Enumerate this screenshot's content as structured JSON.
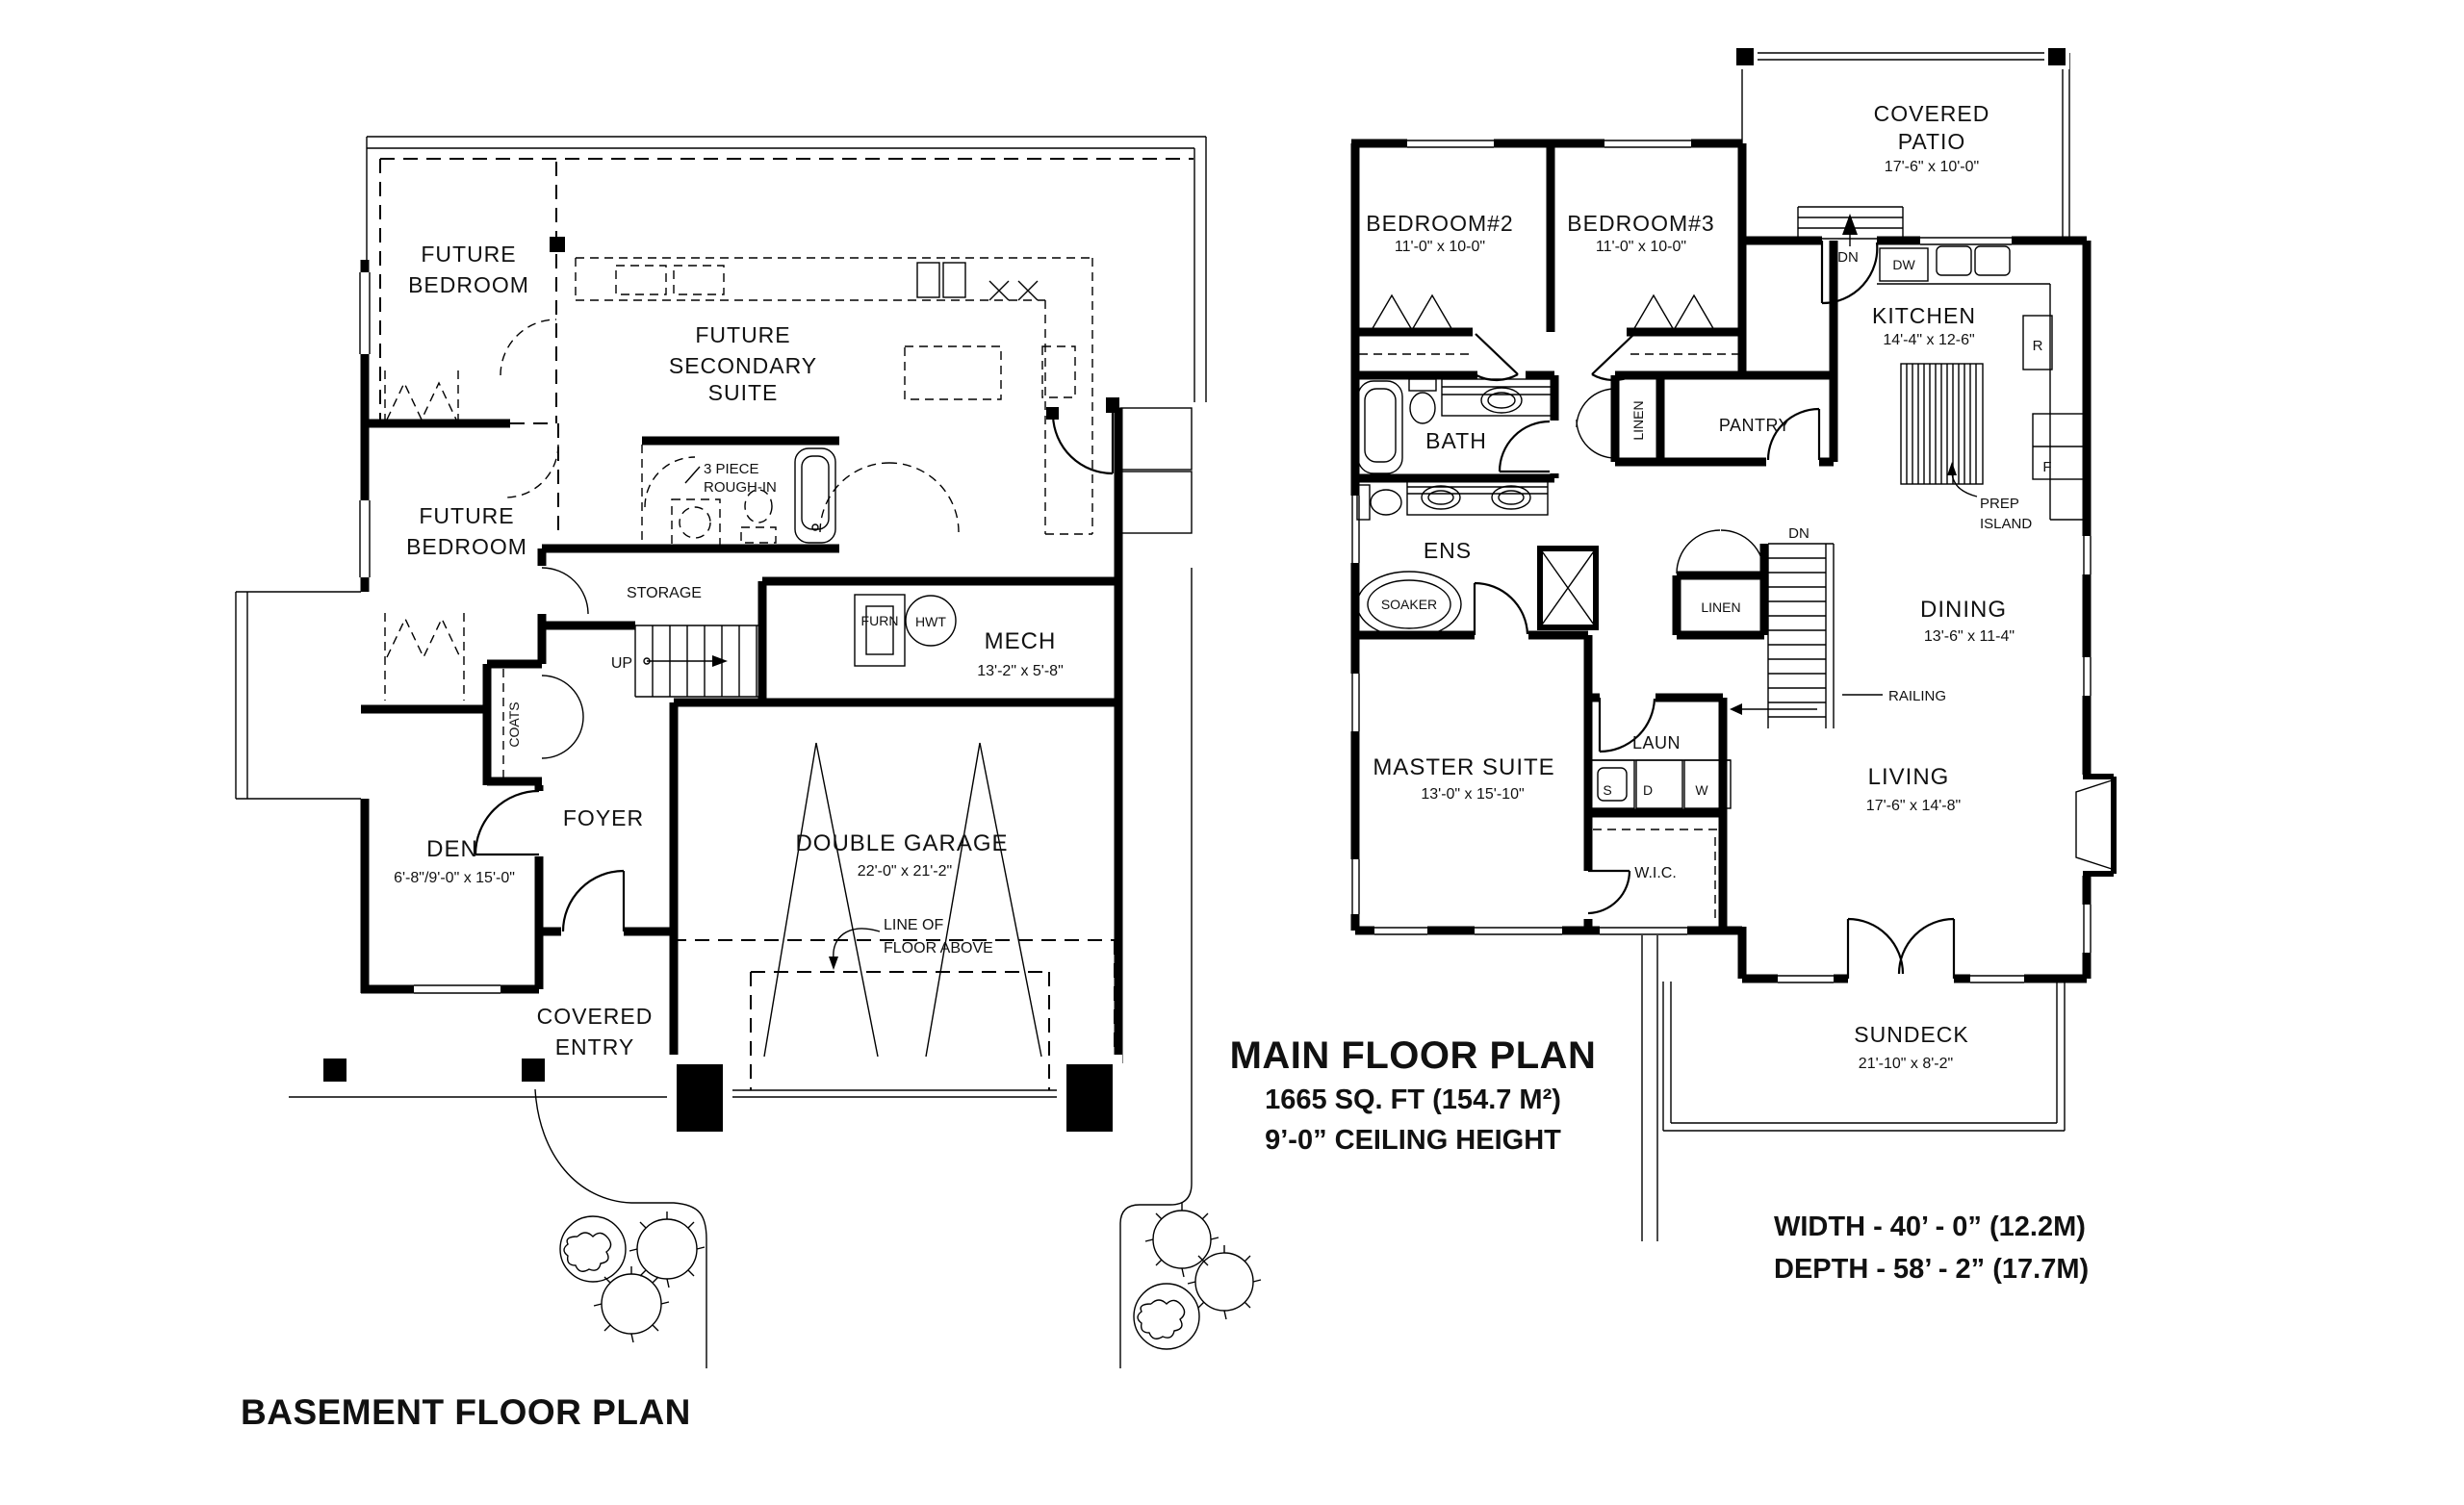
{
  "basement": {
    "title": "BASEMENT FLOOR PLAN",
    "labels": {
      "future_bedroom1_l1": "FUTURE",
      "future_bedroom1_l2": "BEDROOM",
      "future_suite_l1": "FUTURE",
      "future_suite_l2": "SECONDARY",
      "future_suite_l3": "SUITE",
      "rough_in_l1": "3 PIECE",
      "rough_in_l2": "ROUGH-IN",
      "future_bedroom2_l1": "FUTURE",
      "future_bedroom2_l2": "BEDROOM",
      "storage": "STORAGE",
      "up": "UP",
      "coats": "COATS",
      "furn": "FURN",
      "hwt": "HWT",
      "mech": "MECH",
      "mech_dims": "13'-2\" x 5'-8\"",
      "den": "DEN",
      "den_dims": "6'-8\"/9'-0\" x 15'-0\"",
      "foyer": "FOYER",
      "covered_entry_l1": "COVERED",
      "covered_entry_l2": "ENTRY",
      "double_garage": "DOUBLE GARAGE",
      "garage_dims": "22'-0\" x 21'-2\"",
      "line_floor_l1": "LINE OF",
      "line_floor_l2": "FLOOR ABOVE"
    }
  },
  "main": {
    "title_l1": "MAIN FLOOR PLAN",
    "title_l2": "1665 SQ. FT (154.7 M²)",
    "title_l3": "9’-0” CEILING HEIGHT",
    "labels": {
      "bedroom2": "BEDROOM#2",
      "bedroom2_dims": "11'-0\" x 10-0\"",
      "bedroom3": "BEDROOM#3",
      "bedroom3_dims": "11'-0\" x 10-0\"",
      "covered_patio_l1": "COVERED",
      "covered_patio_l2": "PATIO",
      "patio_dims": "17'-6\" x 10'-0\"",
      "dn_patio": "DN",
      "dw": "DW",
      "kitchen": "KITCHEN",
      "kitchen_dims": "14'-4\" x 12-6\"",
      "range": "R",
      "fridge": "F",
      "prep_island_l1": "PREP",
      "prep_island_l2": "ISLAND",
      "bath": "BATH",
      "linen_top": "LINEN",
      "pantry": "PANTRY",
      "ens": "ENS",
      "soaker": "SOAKER",
      "linen_mid": "LINEN",
      "dn_stairs": "DN",
      "railing": "RAILING",
      "dining": "DINING",
      "dining_dims": "13'-6\" x 11-4\"",
      "master": "MASTER SUITE",
      "master_dims": "13'-0\" x 15'-10\"",
      "laun": "LAUN",
      "s": "S",
      "d": "D",
      "w": "W",
      "wic": "W.I.C.",
      "living": "LIVING",
      "living_dims": "17'-6\" x 14'-8\"",
      "sundeck": "SUNDECK",
      "sundeck_dims": "21'-10\" x 8'-2\""
    }
  },
  "overall": {
    "width": "WIDTH - 40’ - 0” (12.2M)",
    "depth": "DEPTH - 58’ - 2” (17.7M)"
  }
}
